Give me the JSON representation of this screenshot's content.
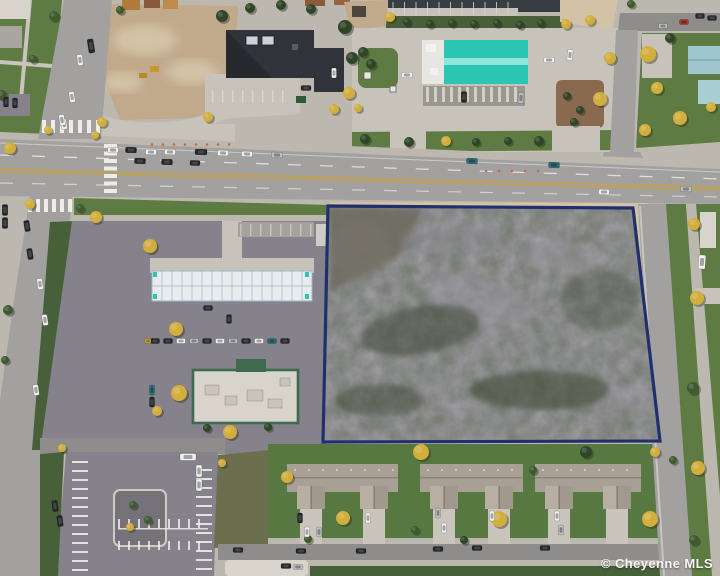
{
  "image": {
    "description": "Aerial drone photo of a vacant commercial lot outlined in dark blue at a city intersection, surrounded by roads, parking lots, a teal-roofed car wash, a restaurant, construction dirt lots and townhomes"
  },
  "watermark": {
    "text": "© Cheyenne MLS"
  },
  "parcel": {
    "outline_color": "#20306f",
    "outline_width": 3.2
  },
  "colors": {
    "parcel_outline": "#20306f",
    "lot_base": "#575952",
    "road": "#a3a1a0",
    "road_dark": "#8f8d8c",
    "asphalt": "#85828b",
    "concrete": "#c7c3ba",
    "sidewalk": "#bcb8b0",
    "grass": "#5f7b44",
    "grass_dark": "#47603a",
    "lawn": "#587842",
    "olive_field": "#6c6f4d",
    "dirt": "#c1a98c",
    "dirt_light": "#d3c3a6",
    "teal_roof": "#2cc5b3",
    "teal_roof_light": "#8fe6da",
    "dark_roof": "#30343a",
    "tan_roof": "#a9a095",
    "tan_roof_light": "#b8afa2",
    "white_roof": "#d8d4cb",
    "green_trim": "#3e6b4f",
    "mulch": "#8a6a4e",
    "water": "#383d44",
    "tree_green": "#3f5a31",
    "tree_dark": "#2f4527",
    "tree_yellow": "#d2ae3c",
    "car_white": "#f0f0ee",
    "car_dark": "#24262a",
    "car_silver": "#bdbfc1",
    "car_teal": "#2b6f78",
    "car_red": "#a83a2e",
    "car_yellow": "#d2a72e",
    "marking_white": "#f4f2ee",
    "marking_yellow": "#c8a23c",
    "cone_orange": "#cf6a2a",
    "watermark": "#ffffff"
  }
}
